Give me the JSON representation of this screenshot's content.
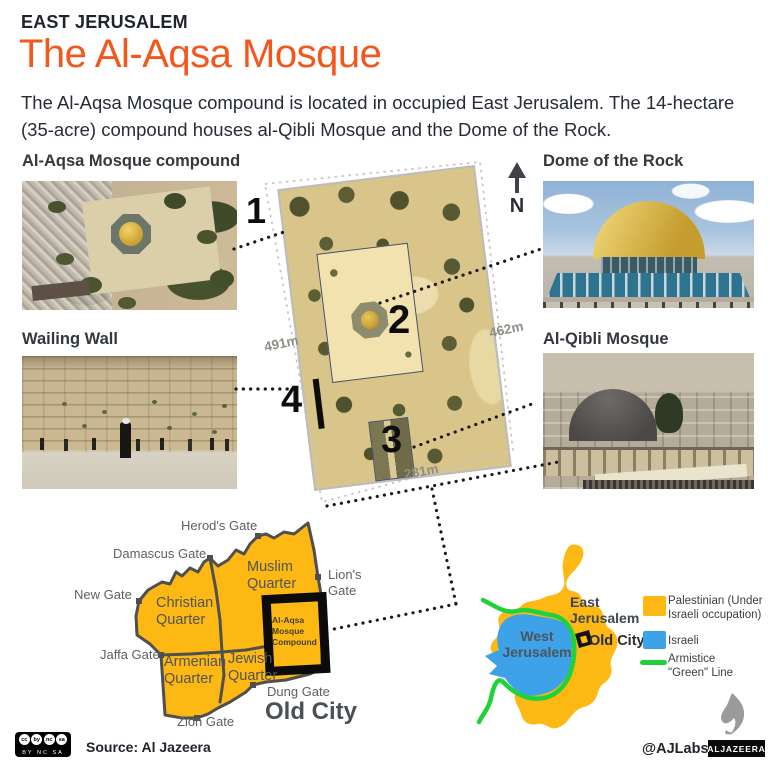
{
  "header": {
    "kicker": "EAST JERUSALEM",
    "title": "The Al-Aqsa Mosque",
    "intro": "The Al-Aqsa Mosque compound is located in occupied East Jerusalem. The 14-hectare (35-acre) compound houses al-Qibli Mosque and the Dome of the Rock."
  },
  "photos": {
    "compound": "Al-Aqsa Mosque compound",
    "dome": "Dome of the Rock",
    "wailing": "Wailing Wall",
    "qibli": "Al-Qibli Mosque"
  },
  "satellite": {
    "m1": "1",
    "m2": "2",
    "m3": "3",
    "m4": "4",
    "dim_left": "491m",
    "dim_right": "462m",
    "dim_bottom": "281m",
    "north": "N"
  },
  "old_city": {
    "title": "Old City",
    "muslim": "Muslim Quarter",
    "christian": "Christian Quarter",
    "armenian": "Armenian Quarter",
    "jewish": "Jewish Quarter",
    "compound": "Al-Aqsa Mosque Compound",
    "gates": {
      "herods": "Herod's Gate",
      "damascus": "Damascus Gate",
      "new": "New Gate",
      "lions": "Lion's Gate",
      "jaffa": "Jaffa Gate",
      "zion": "Zion Gate",
      "dung": "Dung Gate"
    }
  },
  "mini_map": {
    "east": "East Jerusalem",
    "west": "West Jerusalem",
    "old_city": "Old City"
  },
  "legend": {
    "palestinian": "Palestinian (Under Israeli occupation)",
    "israeli": "Israeli",
    "armistice": "Armistice \"Green\" Line"
  },
  "footer": {
    "source": "Source: Al Jazeera",
    "handle": "@AJLabs",
    "brand": "ALJAZEERA",
    "cc": [
      "cc",
      "by",
      "nc",
      "sa"
    ],
    "cc_sub": "BY NC SA"
  },
  "colors": {
    "accent_orange": "#F4571C",
    "palestinian_yellow": "#FDB813",
    "israeli_blue": "#3DA2E8",
    "green_line": "#1FD23C"
  }
}
